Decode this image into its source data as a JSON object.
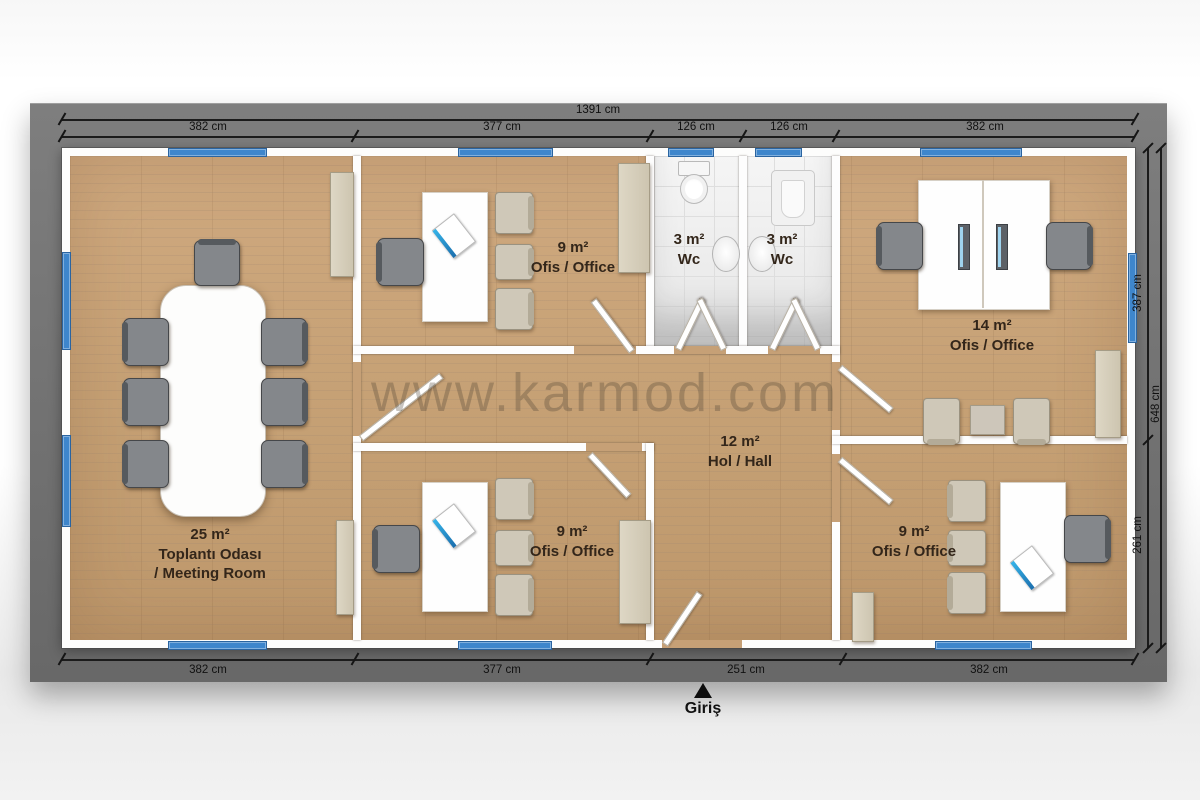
{
  "watermark": "www.karmod.com",
  "entrance_label": "Giriş",
  "dimensions": {
    "top_total": "1391 cm",
    "top_segments": [
      "382 cm",
      "377 cm",
      "126 cm",
      "126 cm",
      "382 cm"
    ],
    "bottom_segments": [
      "382 cm",
      "377 cm",
      "251 cm",
      "382 cm"
    ],
    "right_segments": [
      "387 cm",
      "261 cm"
    ],
    "right_total": "648 cm"
  },
  "rooms": {
    "meeting": {
      "area": "25 m²",
      "line2": "Toplantı Odası",
      "line3": "/ Meeting Room"
    },
    "office_top": {
      "area": "9 m²",
      "name": "Ofis / Office"
    },
    "wc_left": {
      "area": "3 m²",
      "name": "Wc"
    },
    "wc_right": {
      "area": "3 m²",
      "name": "Wc"
    },
    "office_right": {
      "area": "14 m²",
      "name": "Ofis / Office"
    },
    "hall": {
      "area": "12 m²",
      "name": "Hol / Hall"
    },
    "office_bottom": {
      "area": "9 m²",
      "name": "Ofis / Office"
    },
    "office_bottom_right": {
      "area": "9 m²",
      "name": "Ofis / Office"
    }
  },
  "colors": {
    "window_blue": "#3e86cc",
    "frame_gray": "#747474",
    "wood_floor": "#c6a076",
    "wall_white": "#fdfdfd"
  }
}
